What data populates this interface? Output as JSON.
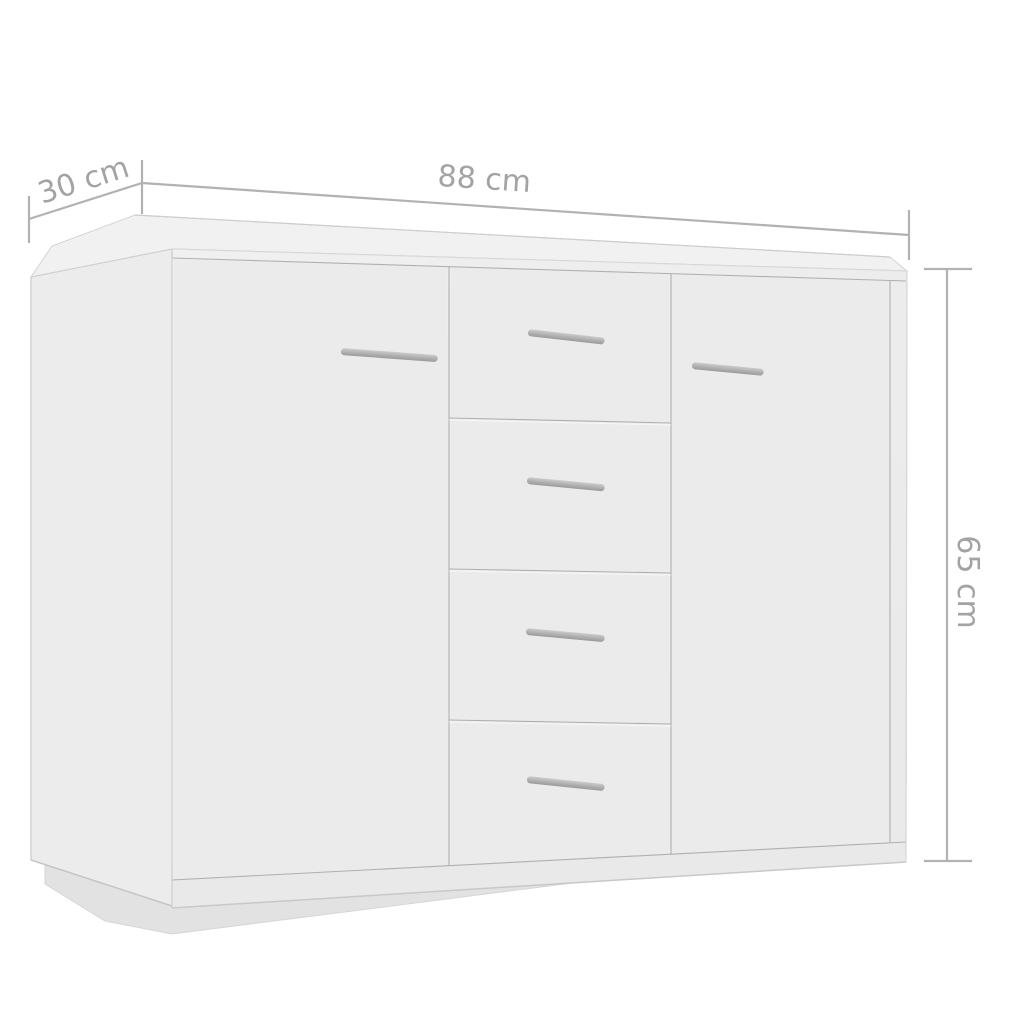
{
  "image_type": "product-dimension-diagram",
  "product": {
    "type": "sideboard",
    "description": "white sideboard with 2 doors and 4 center drawers on a recessed plinth, shown in three-quarter perspective"
  },
  "dimensions": {
    "width": "88 cm",
    "depth": "30 cm",
    "height": "65 cm"
  },
  "colors": {
    "background": "#ffffff",
    "dimension_line": "#b2b2b2",
    "dimension_text": "#a3a3a3",
    "cabinet_top": "#f1f1f1",
    "cabinet_side": "#ececec",
    "cabinet_front": "#efefef",
    "panel": "#ebebeb",
    "plinth_rail": "#e9e9e9",
    "plinth_base": "#e2e2e2",
    "gap_line": "#a0a0a0",
    "gap_highlight": "#f9f9f9",
    "edge_line": "#cfcfcf",
    "handle_light": "#cccccc",
    "handle_dark": "#9a9a9a"
  }
}
